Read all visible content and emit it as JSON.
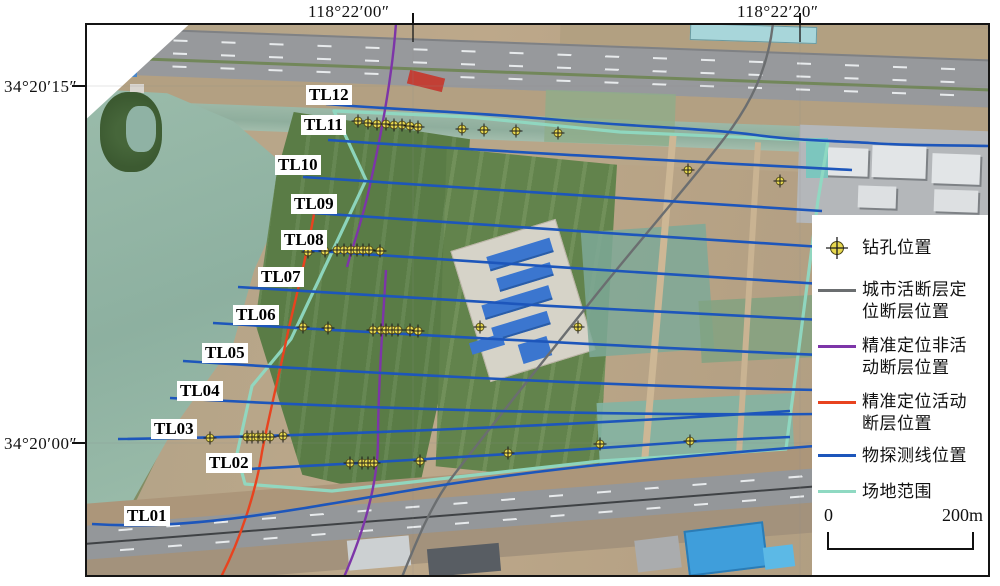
{
  "geo_labels": {
    "top": [
      {
        "text": "118°22′00″"
      },
      {
        "text": "118°22′20″"
      }
    ],
    "left": [
      {
        "text": "34°20′15″"
      },
      {
        "text": "34°20′00″"
      }
    ]
  },
  "survey_lines": {
    "labels": [
      "TL01",
      "TL02",
      "TL03",
      "TL04",
      "TL05",
      "TL06",
      "TL07",
      "TL08",
      "TL09",
      "TL10",
      "TL11",
      "TL12"
    ],
    "color": "#1d56bb"
  },
  "legend": {
    "items": [
      {
        "key": "borehole",
        "symbol": "borehole",
        "color": "#e8d84e",
        "label": "钻孔位置"
      },
      {
        "key": "urban-fault",
        "symbol": "line",
        "color": "#6b6e70",
        "label": "城市活断层定位断层位置"
      },
      {
        "key": "inactive-fault",
        "symbol": "line",
        "color": "#7d35a8",
        "label": "精准定位非活动断层位置"
      },
      {
        "key": "active-fault",
        "symbol": "line",
        "color": "#e8431f",
        "label": "精准定位活动断层位置"
      },
      {
        "key": "survey-line",
        "symbol": "line",
        "color": "#1d56bb",
        "label": "物探测线位置"
      },
      {
        "key": "site-extent",
        "symbol": "line",
        "color": "#8fd9c2",
        "label": "场地范围"
      }
    ]
  },
  "scale_bar": {
    "start_label": "0",
    "end_label": "200m"
  }
}
